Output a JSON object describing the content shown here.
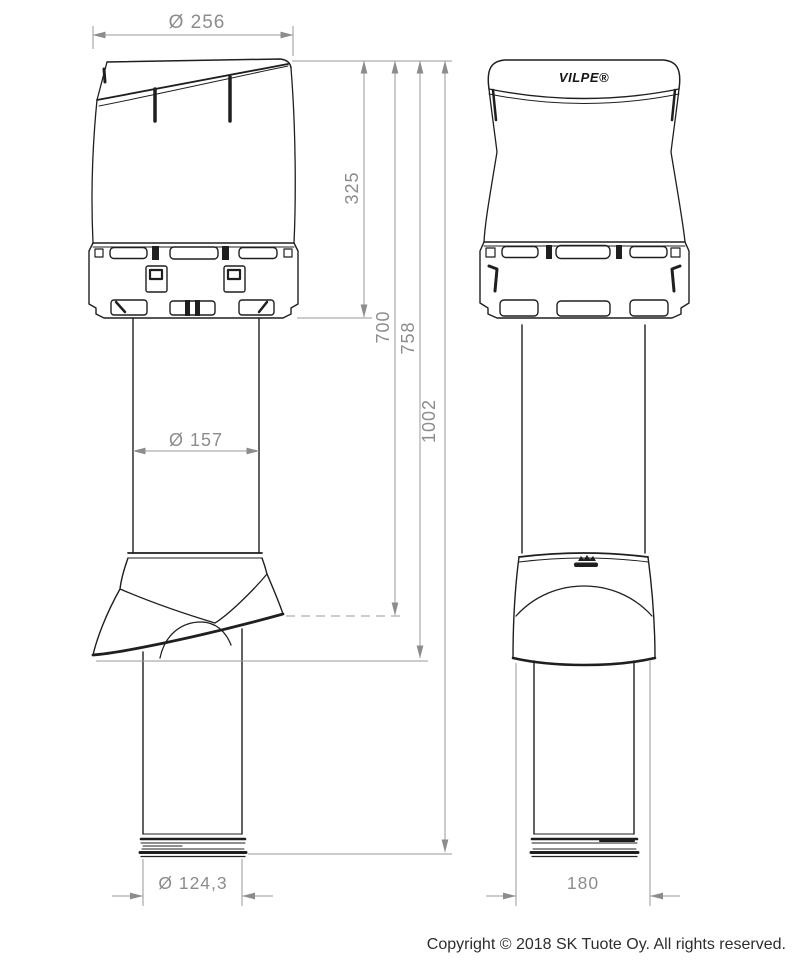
{
  "dimensions": {
    "top_hood_diameter": "Ø 256",
    "hood_height": "325",
    "height_700": "700",
    "height_758": "758",
    "total_height": "1002",
    "pipe_diameter": "Ø 157",
    "lower_pipe_diameter": "Ø 124,3",
    "flashing_width": "180"
  },
  "logos": {
    "vilpe": "VILPE®"
  },
  "footer": {
    "copyright": "Copyright © 2018 SK Tuote Oy. All rights reserved."
  },
  "palette": {
    "product_line": "#1f1f1f",
    "dimension_line": "#9a9a9a",
    "dimension_text": "#8c8c8c"
  }
}
